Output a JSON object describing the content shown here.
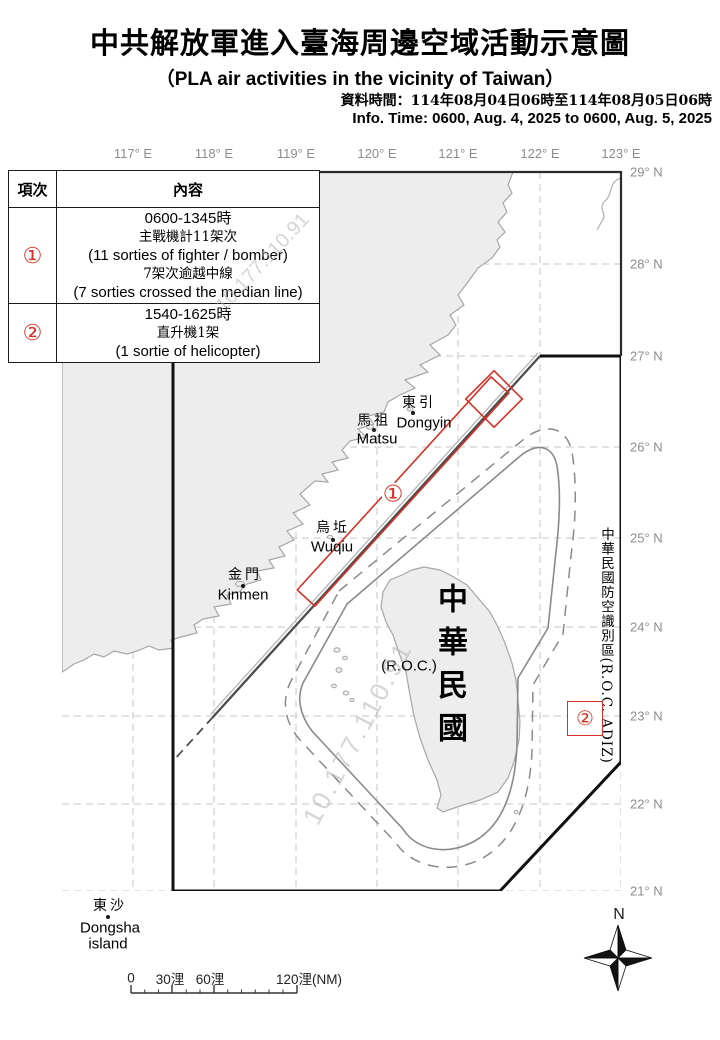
{
  "header": {
    "title_zh": "中共解放軍進入臺海周邊空域活動示意圖",
    "subtitle_en": "（PLA air activities in the vicinity of Taiwan）",
    "info_zh": "資料時間：114年08月04日06時至114年08月05日06時",
    "info_en": "Info. Time: 0600, Aug. 4, 2025 to 0600, Aug. 5, 2025"
  },
  "table": {
    "col_item": "項次",
    "col_content": "內容",
    "rows": [
      {
        "item": "①",
        "lines": [
          "0600-1345時",
          "主戰機計11架次",
          "(11 sorties of fighter / bomber)",
          "7架次逾越中線",
          "(7 sorties crossed the median line)"
        ]
      },
      {
        "item": "②",
        "lines": [
          "1540-1625時",
          "直升機1架",
          "(1 sortie of helicopter)"
        ]
      }
    ]
  },
  "map": {
    "lon_labels": [
      "117° E",
      "118° E",
      "119° E",
      "120° E",
      "121° E",
      "122° E",
      "123° E"
    ],
    "lat_labels": [
      "29° N",
      "28° N",
      "27° N",
      "26° N",
      "25° N",
      "24° N",
      "23° N",
      "22° N",
      "21° N"
    ],
    "labels": {
      "dongyin_zh": "東引",
      "dongyin_en": "Dongyin",
      "matsu_zh": "馬祖",
      "matsu_en": "Matsu",
      "wuqiu_zh": "烏坵",
      "wuqiu_en": "Wuqiu",
      "kinmen_zh": "金門",
      "kinmen_en": "Kinmen",
      "dongsha_zh": "東沙",
      "dongsha_en1": "Dongsha",
      "dongsha_en2": "island",
      "roc_vertical": "中華民國",
      "roc_paren": "(R.O.C.)",
      "adiz_vertical": "中華民國防空識別區(R.O.C. ADIZ)"
    },
    "markers": {
      "area1": "①",
      "area2": "②"
    },
    "compass_n": "N",
    "watermark": "10.177.110.91",
    "colors": {
      "activity_red": "#d93025",
      "adiz_line": "#111111",
      "median_line": "#4d4d4d",
      "grid": "#c4c4c4",
      "land_fill": "#ededed",
      "land_stroke": "#a6a6a6",
      "axis_label": "#8c8c8c"
    }
  },
  "scalebar": {
    "labels": [
      "0",
      "30浬",
      "60浬",
      "120浬(NM)"
    ]
  }
}
